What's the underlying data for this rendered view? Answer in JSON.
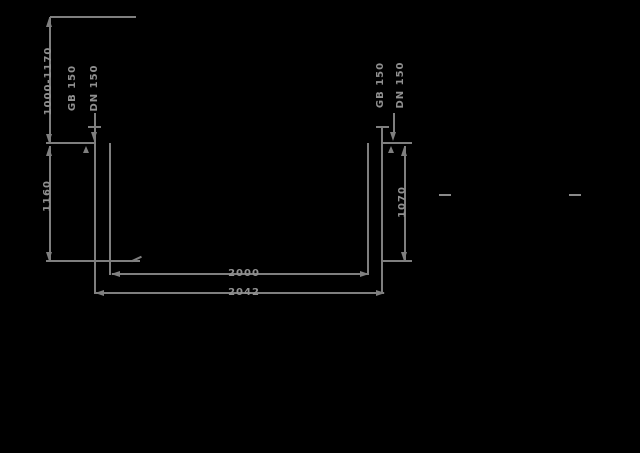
{
  "figure": {
    "background_color": "#000000",
    "line_color": "#7f7f7f",
    "text_color": "#909090"
  },
  "annotations": {
    "height_range": "1000-1170",
    "left_height": "1160",
    "right_height": "1070",
    "inner_width": "2000",
    "outer_width": "2042",
    "left_pipe_line1": "GB 150",
    "left_pipe_line2": "DN 150",
    "right_pipe_line1": "GB 150",
    "right_pipe_line2": "DN 150"
  }
}
